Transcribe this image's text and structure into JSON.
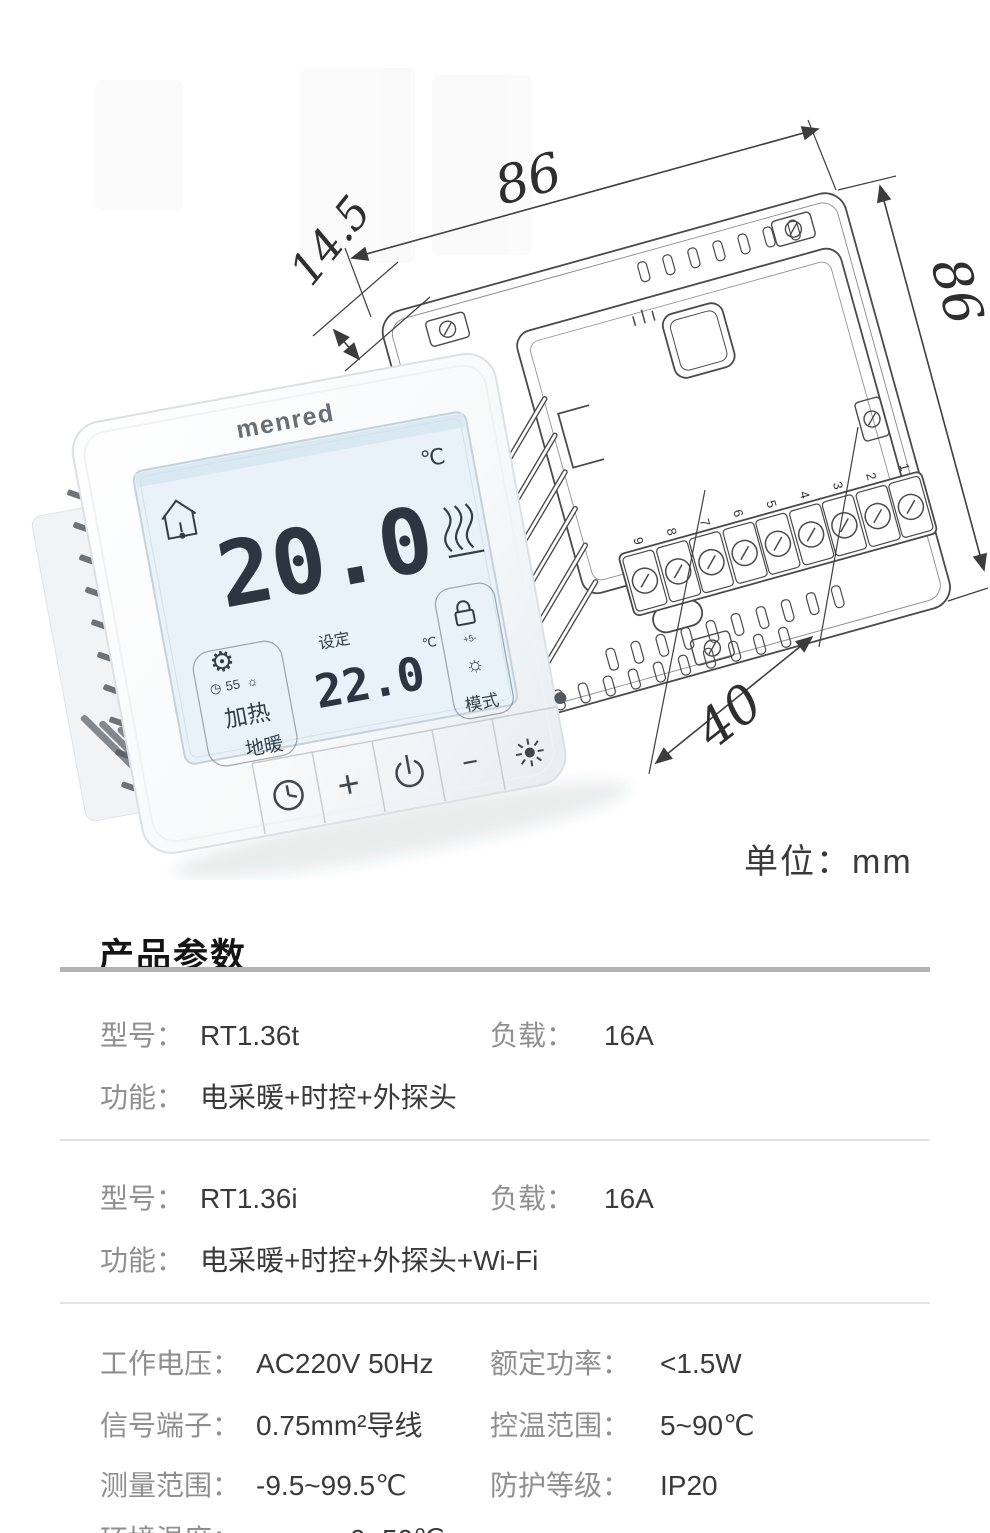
{
  "illustration": {
    "unit_label": "单位：mm",
    "dims": {
      "width_top": "86",
      "height_right": "86",
      "depth_left": "14.5",
      "span_bottom": "40"
    },
    "terminals": [
      "1",
      "2",
      "3",
      "4",
      "5",
      "6",
      "7",
      "8",
      "9"
    ],
    "device": {
      "brand": "menred",
      "screen": {
        "room_temp": "20.0",
        "room_temp_unit": "℃",
        "program_num": "55",
        "set_label": "设定",
        "set_temp": "22.0",
        "set_temp_unit": "℃",
        "heating_label": "加热",
        "floor_label": "地暖",
        "mode_label": "模式",
        "scale_marks": "+5-"
      },
      "keys": {
        "plus": "+",
        "minus": "--"
      }
    },
    "icons": {
      "gear": "⚙",
      "small_clock": "◷",
      "small_sun": "☼"
    }
  },
  "params": {
    "title": "产品参数",
    "blocks": [
      {
        "rows": [
          {
            "l1": "型号：",
            "v1": "RT1.36t",
            "l2": "负载：",
            "v2": "16A"
          },
          {
            "l1": "功能：",
            "v1": "电采暖+时控+外探头",
            "l2": "",
            "v2": ""
          }
        ]
      },
      {
        "rows": [
          {
            "l1": "型号：",
            "v1": "RT1.36i",
            "l2": "负载：",
            "v2": "16A"
          },
          {
            "l1": "功能：",
            "v1": "电采暖+时控+外探头+Wi-Fi",
            "l2": "",
            "v2": ""
          }
        ]
      },
      {
        "rows": [
          {
            "l1": "工作电压：",
            "v1": "AC220V 50Hz",
            "l2": "额定功率：",
            "v2": "<1.5W"
          },
          {
            "l1": "信号端子：",
            "v1": "0.75mm²导线",
            "l2": "控温范围：",
            "v2": "5~90℃"
          },
          {
            "l1": "测量范围：",
            "v1": "-9.5~99.5℃",
            "l2": "防护等级：",
            "v2": "IP20"
          },
          {
            "l1": "环境温度：",
            "v1": "0~50℃",
            "l2": "",
            "v2": ""
          }
        ]
      }
    ]
  },
  "colors": {
    "screen_bg": "#e8f2f8",
    "line": "#4a4a4a",
    "label_gray": "#8f8f8f",
    "value_dark": "#3a3a3a",
    "divider_strong": "#b3b3b3",
    "divider_light": "#e3e3e3"
  }
}
